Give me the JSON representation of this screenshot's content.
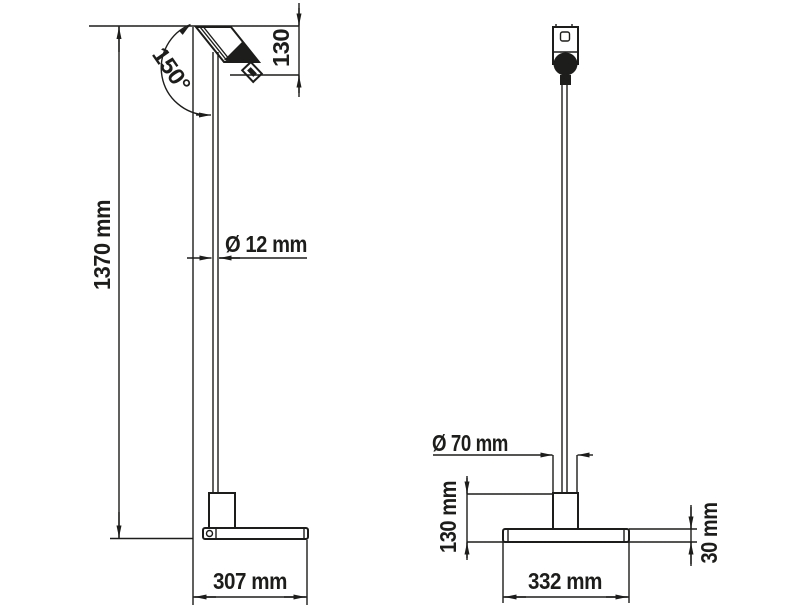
{
  "drawing": {
    "type": "technical-dimension-drawing",
    "subject": "floor lamp with tilted cylindrical head, thin stem, counterweight and flat base plate",
    "colors": {
      "ink": "#1d1d1b",
      "background": "#ffffff"
    },
    "side_view": {
      "name": "side view",
      "dimensions": {
        "total_height": "1370 mm",
        "head_height": "130",
        "head_angle": "150°",
        "stem_diameter": "Ø 12 mm",
        "base_depth": "307 mm"
      }
    },
    "front_view": {
      "name": "front view",
      "dimensions": {
        "counterweight_diameter": "Ø 70 mm",
        "base_assembly_height": "130 mm",
        "base_width": "332 mm",
        "base_plate_thickness": "30 mm"
      }
    }
  }
}
